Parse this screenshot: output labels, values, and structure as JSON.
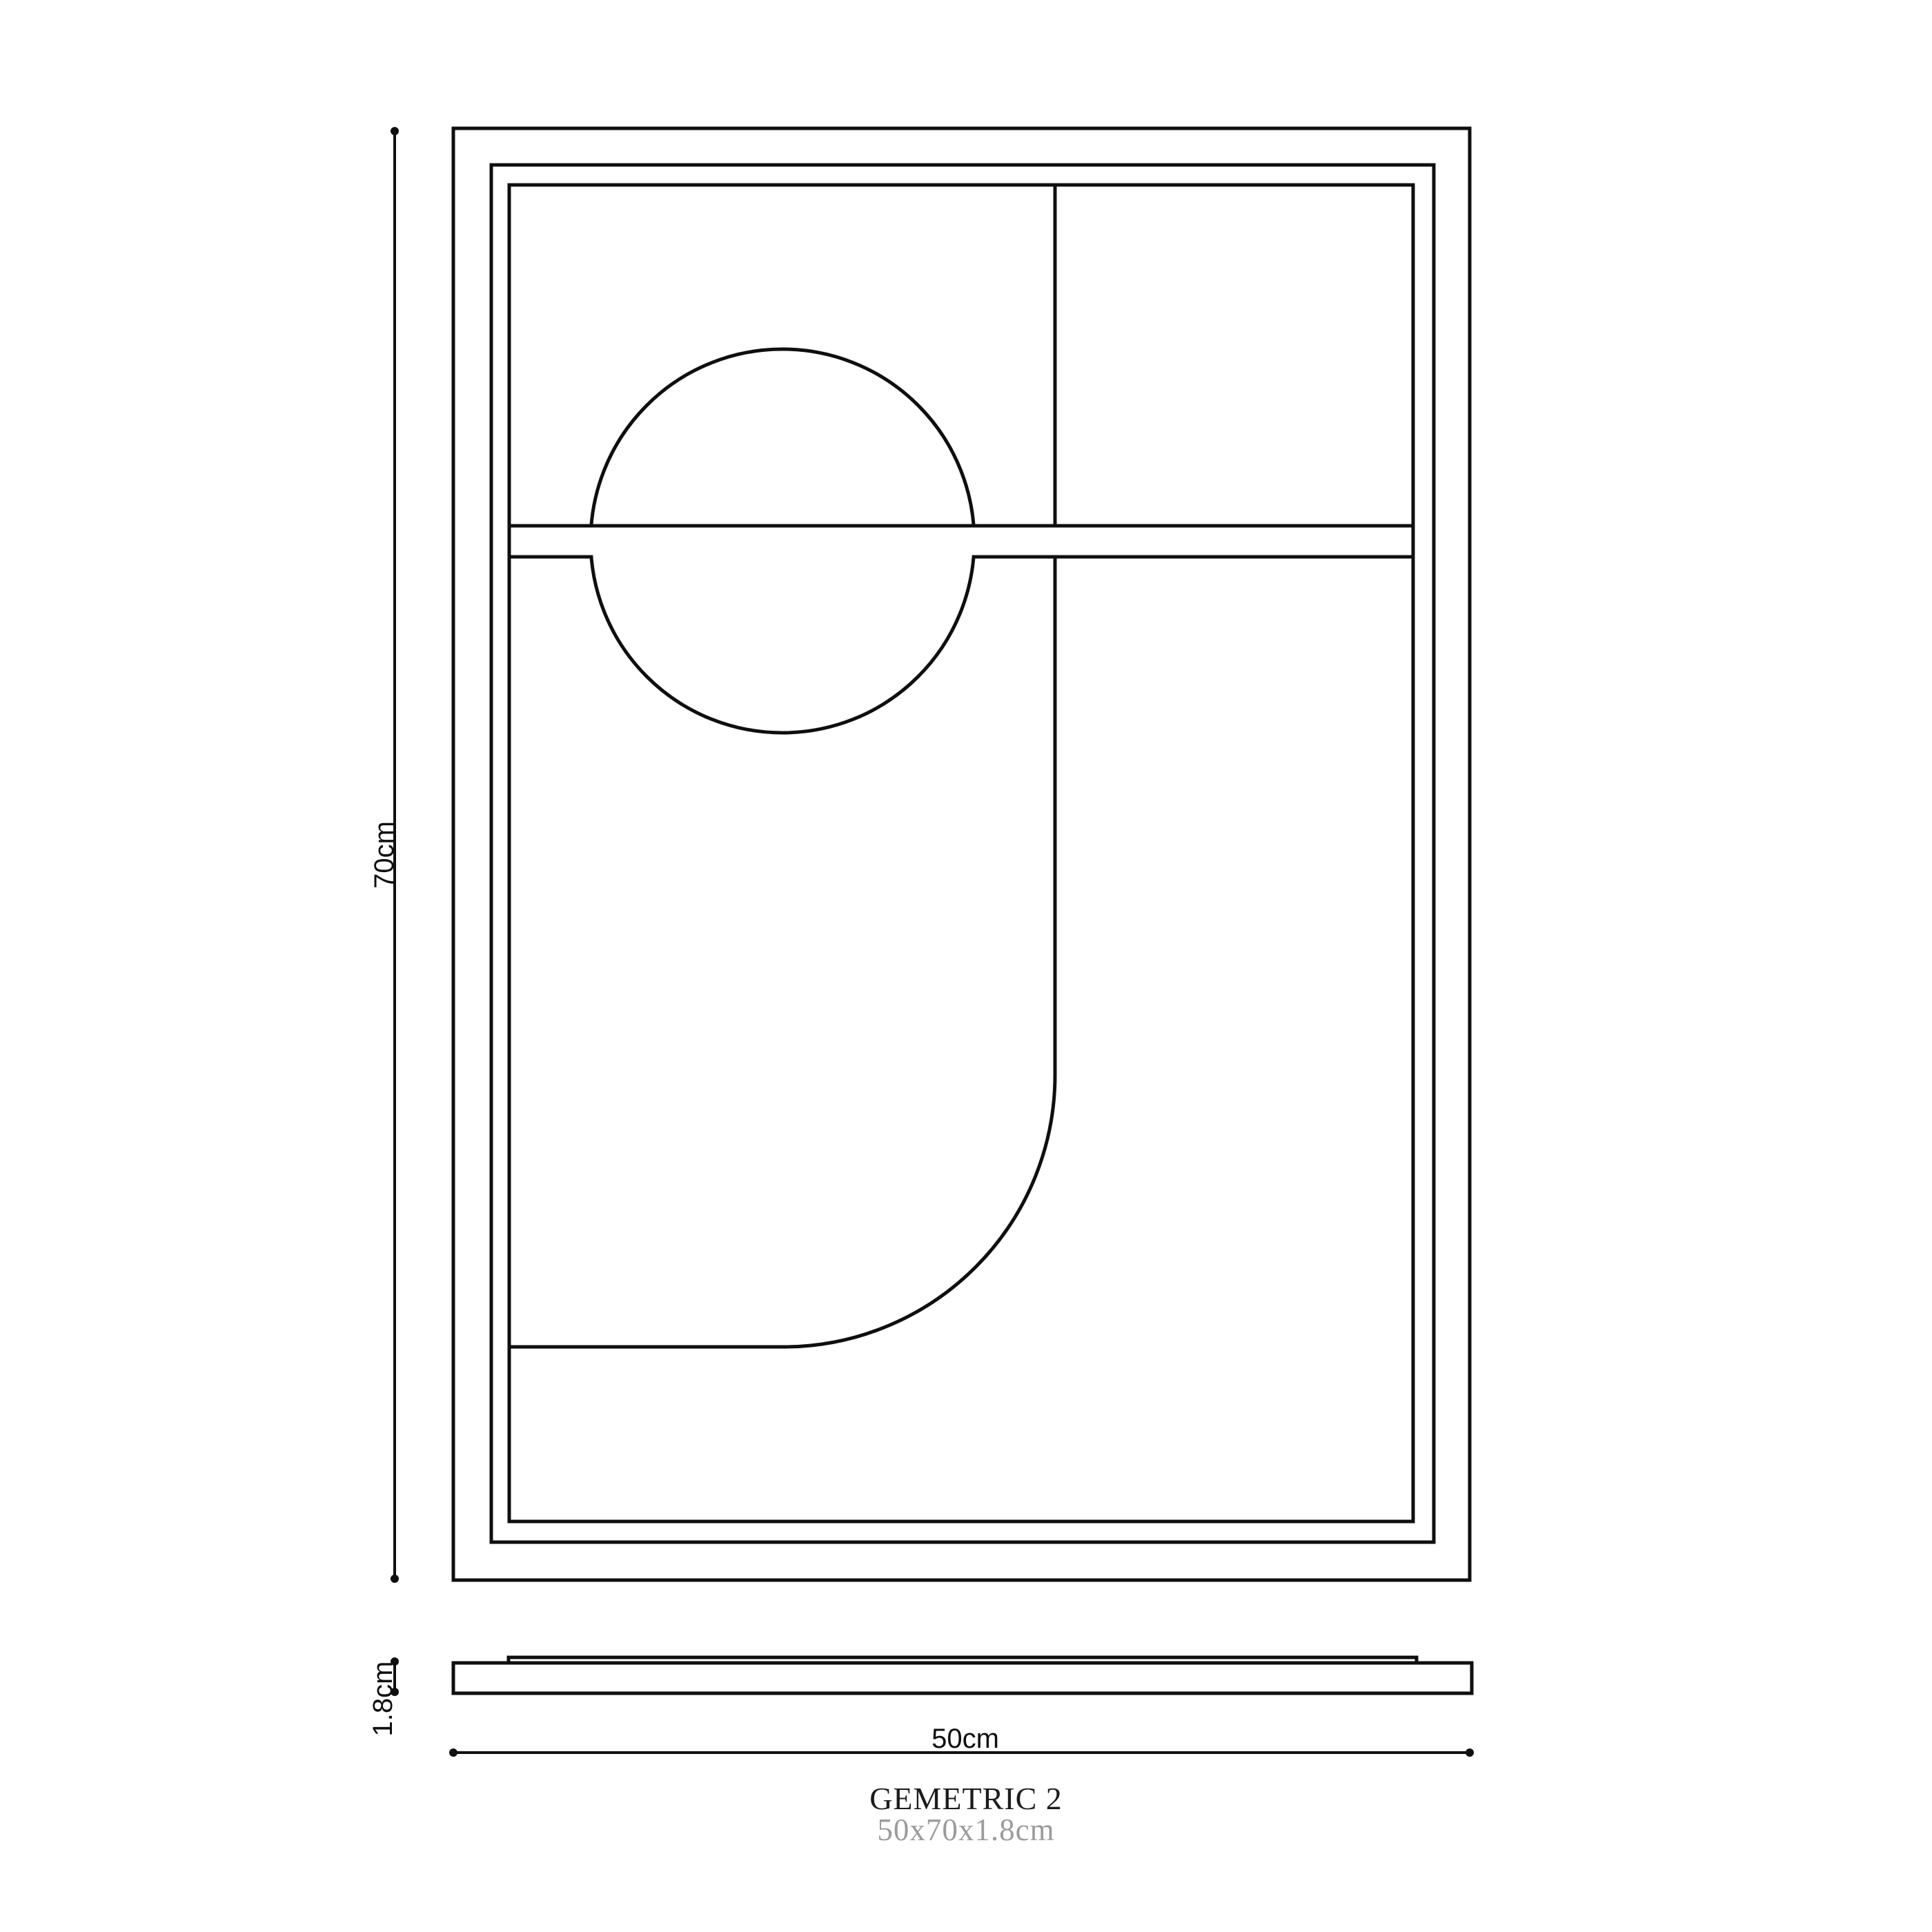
{
  "drawing": {
    "title": "GEMETRIC 2",
    "subtitle": "50x70x1.8cm"
  },
  "dimensions": {
    "height_label": "70cm",
    "thickness_label": "1.8cm",
    "width_label": "50cm"
  },
  "colors": {
    "line": "#0f0f0f",
    "title": "#1c1c1c",
    "subtitle": "#9b9b9b",
    "background": "#ffffff"
  }
}
